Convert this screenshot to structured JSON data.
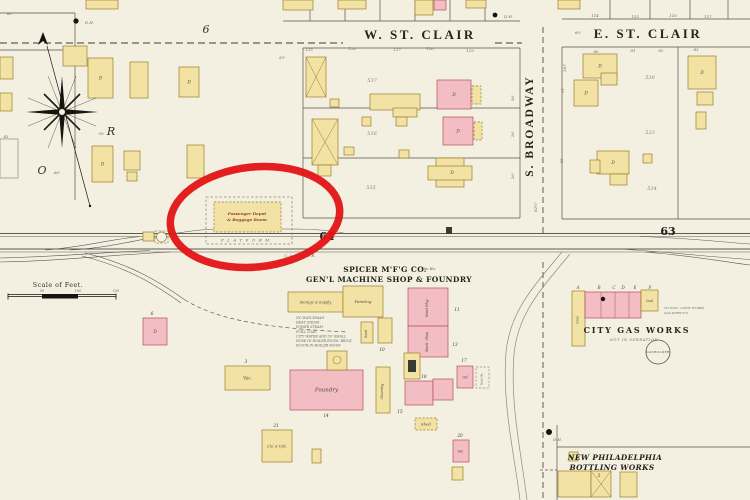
{
  "colors": {
    "paper": "#f4f0e1",
    "building_yellow": "#f2e2a4",
    "building_pink": "#f3bdc4",
    "annotation_red": "#e11414"
  },
  "labels": {
    "w_st_clair": "W. ST. CLAIR",
    "e_st_clair": "E. ST. CLAIR",
    "s_broadway": "S. BROADWAY",
    "block_64": "64",
    "block_63": "63",
    "spicer_line1": "SPICER M'F'G CO.",
    "spicer_line2": "GEN'L MACHINE SHOP & FOUNDRY",
    "gas_title": "CITY GAS WORKS",
    "gas_status": "NOT IN OPERATION",
    "gasholder": "GASHOLDER",
    "bottling_line1": "NEW PHILADELPHIA",
    "bottling_line2": "BOTTLING WORKS",
    "scale_title": "Scale of Feet.",
    "depot_line1": "Passenger Depot",
    "depot_line2": "& Baggage Room",
    "platform": "PLATFORM",
    "railroad_name": "C. L. & W. R. R."
  },
  "fire_notes": [
    "NO WATCHMAN",
    "HEAT STEAM",
    "POWER STEAM",
    "FUEL COAL",
    "CITY WATER AND 50' SMALL",
    "HOSE IN BOILER ROOM, BRICK",
    "FLOOR IN BOILER ROOM"
  ],
  "buildings": [
    {
      "x": 63,
      "y": 46,
      "w": 24,
      "h": 20,
      "f": "y"
    },
    {
      "x": 88,
      "y": 58,
      "w": 25,
      "h": 40,
      "f": "y",
      "l": "D",
      "n": "dwelling"
    },
    {
      "x": 130,
      "y": 62,
      "w": 18,
      "h": 36,
      "f": "y"
    },
    {
      "x": 179,
      "y": 67,
      "w": 20,
      "h": 30,
      "f": "y",
      "l": "D",
      "n": "dwelling"
    },
    {
      "x": 92,
      "y": 146,
      "w": 21,
      "h": 36,
      "f": "y",
      "l": "D",
      "n": "dwelling"
    },
    {
      "x": 124,
      "y": 151,
      "w": 16,
      "h": 19,
      "f": "y"
    },
    {
      "x": 187,
      "y": 145,
      "w": 17,
      "h": 33,
      "f": "y"
    },
    {
      "x": 127,
      "y": 172,
      "w": 10,
      "h": 9,
      "f": "y"
    },
    {
      "x": 0,
      "y": 57,
      "w": 13,
      "h": 22,
      "f": "y"
    },
    {
      "x": 0,
      "y": 93,
      "w": 12,
      "h": 18,
      "f": "y"
    },
    {
      "x": 0,
      "y": 139,
      "w": 18,
      "h": 39,
      "f": "n"
    },
    {
      "x": 86,
      "y": 0,
      "w": 32,
      "h": 9,
      "f": "y"
    },
    {
      "x": 283,
      "y": 0,
      "w": 30,
      "h": 10,
      "f": "y"
    },
    {
      "x": 338,
      "y": 0,
      "w": 28,
      "h": 9,
      "f": "y"
    },
    {
      "x": 415,
      "y": 0,
      "w": 18,
      "h": 15,
      "f": "y"
    },
    {
      "x": 434,
      "y": 0,
      "w": 12,
      "h": 10,
      "f": "p"
    },
    {
      "x": 466,
      "y": 0,
      "w": 20,
      "h": 8,
      "f": "y"
    },
    {
      "x": 558,
      "y": 0,
      "w": 22,
      "h": 9,
      "f": "y"
    },
    {
      "x": 306,
      "y": 57,
      "w": 20,
      "h": 40,
      "f": "y",
      "xm": true,
      "n": "stable"
    },
    {
      "x": 312,
      "y": 119,
      "w": 26,
      "h": 46,
      "f": "y",
      "xm": true,
      "n": "stable"
    },
    {
      "x": 318,
      "y": 165,
      "w": 13,
      "h": 11,
      "f": "y"
    },
    {
      "x": 330,
      "y": 99,
      "w": 9,
      "h": 8,
      "f": "y"
    },
    {
      "x": 370,
      "y": 94,
      "w": 50,
      "h": 16,
      "f": "y"
    },
    {
      "x": 393,
      "y": 108,
      "w": 24,
      "h": 9,
      "f": "y"
    },
    {
      "x": 437,
      "y": 80,
      "w": 34,
      "h": 29,
      "f": "p",
      "l": "D",
      "n": "dwelling"
    },
    {
      "x": 472,
      "y": 86,
      "w": 9,
      "h": 18,
      "f": "y",
      "dash": true,
      "n": "porch"
    },
    {
      "x": 362,
      "y": 117,
      "w": 9,
      "h": 9,
      "f": "y"
    },
    {
      "x": 396,
      "y": 117,
      "w": 11,
      "h": 9,
      "f": "y"
    },
    {
      "x": 443,
      "y": 117,
      "w": 30,
      "h": 28,
      "f": "p",
      "l": "D",
      "n": "dwelling"
    },
    {
      "x": 474,
      "y": 122,
      "w": 8,
      "h": 18,
      "f": "y",
      "dash": true,
      "n": "porch"
    },
    {
      "x": 344,
      "y": 147,
      "w": 10,
      "h": 8,
      "f": "y"
    },
    {
      "x": 399,
      "y": 150,
      "w": 10,
      "h": 8,
      "f": "y"
    },
    {
      "x": 436,
      "y": 158,
      "w": 28,
      "h": 29,
      "f": "y"
    },
    {
      "x": 428,
      "y": 166,
      "w": 44,
      "h": 14,
      "f": "y",
      "l": "D",
      "lx": 452,
      "ly": 174,
      "n": "dwelling"
    },
    {
      "x": 583,
      "y": 54,
      "w": 34,
      "h": 24,
      "f": "y",
      "l": "D",
      "n": "dwelling"
    },
    {
      "x": 574,
      "y": 80,
      "w": 24,
      "h": 26,
      "f": "y",
      "l": "D",
      "n": "dwelling"
    },
    {
      "x": 601,
      "y": 73,
      "w": 16,
      "h": 12,
      "f": "y"
    },
    {
      "x": 688,
      "y": 56,
      "w": 28,
      "h": 33,
      "f": "y",
      "l": "D",
      "n": "dwelling"
    },
    {
      "x": 697,
      "y": 92,
      "w": 16,
      "h": 13,
      "f": "y"
    },
    {
      "x": 696,
      "y": 112,
      "w": 10,
      "h": 17,
      "f": "y"
    },
    {
      "x": 597,
      "y": 151,
      "w": 32,
      "h": 23,
      "f": "y",
      "l": "D",
      "n": "dwelling"
    },
    {
      "x": 590,
      "y": 160,
      "w": 10,
      "h": 13,
      "f": "y"
    },
    {
      "x": 610,
      "y": 174,
      "w": 17,
      "h": 11,
      "f": "y"
    },
    {
      "x": 643,
      "y": 154,
      "w": 9,
      "h": 9,
      "f": "y"
    },
    {
      "x": 143,
      "y": 318,
      "w": 24,
      "h": 27,
      "f": "p",
      "l": "D",
      "n": "dwelling"
    },
    {
      "x": 225,
      "y": 366,
      "w": 45,
      "h": 24,
      "f": "y",
      "l": "Vac.",
      "n": "vacant-building"
    },
    {
      "x": 262,
      "y": 430,
      "w": 30,
      "h": 32,
      "f": "y",
      "l": "Clo. & Uph.",
      "ls": 3.3
    },
    {
      "x": 312,
      "y": 449,
      "w": 9,
      "h": 14,
      "f": "y"
    },
    {
      "x": 143,
      "y": 232,
      "w": 11,
      "h": 9,
      "f": "y",
      "n": "track-shed"
    },
    {
      "x": 155,
      "y": 231,
      "w": 13,
      "h": 12,
      "f": "n",
      "dash": true,
      "n": "tank-enclosure"
    },
    {
      "x": 214,
      "y": 202,
      "w": 67,
      "h": 30,
      "f": "y",
      "dash": true,
      "n": "passenger-depot"
    },
    {
      "x": 288,
      "y": 292,
      "w": 55,
      "h": 20,
      "f": "y",
      "l": "Storage & Supply",
      "ls": 3.5,
      "n": "storage-supply"
    },
    {
      "x": 343,
      "y": 286,
      "w": 40,
      "h": 31,
      "f": "y",
      "l": "Painting",
      "ls": 4,
      "n": "painting-shop"
    },
    {
      "x": 361,
      "y": 322,
      "w": 12,
      "h": 21,
      "f": "y",
      "l": "Sand",
      "lr": -90,
      "ls": 3.2
    },
    {
      "x": 378,
      "y": 318,
      "w": 14,
      "h": 25,
      "f": "y"
    },
    {
      "x": 408,
      "y": 288,
      "w": 40,
      "h": 38,
      "f": "p",
      "l": "Wood Wkg.",
      "lr": -90,
      "ls": 3.3,
      "lx": 428,
      "ly": 308,
      "n": "wood-working-shop"
    },
    {
      "x": 408,
      "y": 326,
      "w": 40,
      "h": 31,
      "f": "p",
      "l": "Mach. Shop",
      "lr": -90,
      "ls": 3.3,
      "lx": 428,
      "ly": 342,
      "n": "machine-shop"
    },
    {
      "x": 376,
      "y": 367,
      "w": 14,
      "h": 46,
      "f": "y",
      "l": "Cleaning",
      "lr": -90,
      "ls": 3.5,
      "n": "cleaning-shop"
    },
    {
      "x": 404,
      "y": 353,
      "w": 16,
      "h": 26,
      "f": "y",
      "n": "smith-shop"
    },
    {
      "x": 405,
      "y": 381,
      "w": 28,
      "h": 24,
      "f": "p"
    },
    {
      "x": 433,
      "y": 379,
      "w": 20,
      "h": 21,
      "f": "p"
    },
    {
      "x": 290,
      "y": 370,
      "w": 73,
      "h": 40,
      "f": "p",
      "l": "Foundry",
      "ls": 5.5,
      "n": "foundry"
    },
    {
      "x": 327,
      "y": 351,
      "w": 20,
      "h": 19,
      "f": "y",
      "n": "cupola-house"
    },
    {
      "x": 457,
      "y": 366,
      "w": 16,
      "h": 22,
      "f": "p",
      "l": "Oil",
      "ls": 3.6,
      "n": "oil-house"
    },
    {
      "x": 476,
      "y": 367,
      "w": 13,
      "h": 21,
      "f": "n",
      "dash": true,
      "l": "Tank Ho.",
      "lr": -90,
      "ls": 2.8,
      "n": "tank-house"
    },
    {
      "x": 415,
      "y": 418,
      "w": 22,
      "h": 12,
      "f": "y",
      "dash": true,
      "l": "Shed",
      "ls": 4,
      "n": "shed"
    },
    {
      "x": 453,
      "y": 440,
      "w": 16,
      "h": 22,
      "f": "p",
      "l": "Vac.",
      "ls": 3.2,
      "n": "vacant-building"
    },
    {
      "x": 452,
      "y": 467,
      "w": 11,
      "h": 13,
      "f": "y"
    },
    {
      "x": 572,
      "y": 291,
      "w": 13,
      "h": 55,
      "f": "y",
      "l": "Coal",
      "lr": -90,
      "ls": 3.2,
      "n": "gas-works-coal"
    },
    {
      "x": 585,
      "y": 292,
      "w": 56,
      "h": 26,
      "f": "p",
      "n": "gas-works-retort"
    },
    {
      "x": 641,
      "y": 290,
      "w": 17,
      "h": 21,
      "f": "y",
      "l": "Coal",
      "ls": 3.2,
      "n": "gas-works-coal"
    },
    {
      "x": 569,
      "y": 452,
      "w": 9,
      "h": 9,
      "f": "y"
    },
    {
      "x": 558,
      "y": 471,
      "w": 33,
      "h": 26,
      "f": "y",
      "n": "bottling-works"
    },
    {
      "x": 591,
      "y": 471,
      "w": 20,
      "h": 26,
      "f": "y",
      "xm": true,
      "n": "bottling-works"
    },
    {
      "x": 620,
      "y": 472,
      "w": 17,
      "h": 25,
      "f": "y"
    },
    {
      "x": 446,
      "y": 227,
      "w": 6,
      "h": 7,
      "f": "k",
      "n": "watch-box"
    }
  ],
  "small_labels": [
    {
      "t": "537",
      "x": 372,
      "y": 82,
      "c": "tp",
      "n": "parcel-number"
    },
    {
      "t": "536",
      "x": 372,
      "y": 135,
      "c": "tp",
      "n": "parcel-number"
    },
    {
      "t": "535",
      "x": 371,
      "y": 189,
      "c": "tp",
      "n": "parcel-number"
    },
    {
      "t": "538",
      "x": 650,
      "y": 79,
      "c": "tp",
      "n": "parcel-number"
    },
    {
      "t": "533",
      "x": 650,
      "y": 134,
      "c": "tp",
      "n": "parcel-number"
    },
    {
      "t": "534",
      "x": 652,
      "y": 190,
      "c": "tp",
      "n": "parcel-number"
    },
    {
      "t": "125",
      "x": 309,
      "y": 51,
      "n": "lot-number"
    },
    {
      "t": "126",
      "x": 352,
      "y": 50,
      "n": "lot-number"
    },
    {
      "t": "127",
      "x": 397,
      "y": 51,
      "n": "lot-number"
    },
    {
      "t": "128",
      "x": 430,
      "y": 50,
      "n": "lot-number"
    },
    {
      "t": "129",
      "x": 470,
      "y": 52,
      "n": "lot-number"
    },
    {
      "t": "114",
      "x": 595,
      "y": 17,
      "n": "lot-number"
    },
    {
      "t": "115",
      "x": 635,
      "y": 18,
      "n": "lot-number"
    },
    {
      "t": "116",
      "x": 673,
      "y": 17,
      "n": "lot-number"
    },
    {
      "t": "117",
      "x": 708,
      "y": 18,
      "n": "lot-number"
    },
    {
      "t": "80",
      "x": 596,
      "y": 53,
      "n": "lot-number"
    },
    {
      "t": "81",
      "x": 633,
      "y": 52,
      "n": "lot-number"
    },
    {
      "t": "82",
      "x": 661,
      "y": 52,
      "n": "lot-number"
    },
    {
      "t": "83",
      "x": 696,
      "y": 51,
      "n": "lot-number"
    },
    {
      "t": "55'",
      "x": 282,
      "y": 59,
      "n": "measurement"
    },
    {
      "t": "60'",
      "x": 578,
      "y": 34,
      "n": "measurement"
    },
    {
      "t": "66'",
      "x": 57,
      "y": 174,
      "n": "measurement"
    },
    {
      "t": "43",
      "x": 6,
      "y": 138,
      "n": "measurement"
    },
    {
      "t": "60'",
      "x": 10,
      "y": 15,
      "n": "measurement"
    },
    {
      "t": "59",
      "x": 101,
      "y": 135,
      "n": "measurement"
    },
    {
      "t": "367",
      "x": 566,
      "y": 68,
      "r": -90,
      "n": "measurement"
    },
    {
      "t": "51'",
      "x": 564,
      "y": 90,
      "r": -90,
      "n": "measurement"
    },
    {
      "t": "55",
      "x": 563,
      "y": 161,
      "r": -90,
      "n": "measurement"
    },
    {
      "t": "82½'",
      "x": 537,
      "y": 207,
      "r": -90,
      "n": "measurement"
    },
    {
      "t": "26'",
      "x": 514,
      "y": 98,
      "r": -90,
      "n": "measurement"
    },
    {
      "t": "26'",
      "x": 514,
      "y": 134,
      "r": -90,
      "n": "measurement"
    },
    {
      "t": "26'",
      "x": 514,
      "y": 176,
      "r": -90,
      "n": "measurement"
    },
    {
      "t": "11",
      "x": 457,
      "y": 311,
      "c": "tnum",
      "n": "building-number"
    },
    {
      "t": "13",
      "x": 455,
      "y": 346,
      "c": "tnum",
      "n": "building-number"
    },
    {
      "t": "17",
      "x": 464,
      "y": 362,
      "c": "tnum",
      "n": "building-number"
    },
    {
      "t": "18",
      "x": 424,
      "y": 378,
      "c": "tnum",
      "n": "building-number"
    },
    {
      "t": "14",
      "x": 326,
      "y": 417,
      "c": "tnum",
      "n": "building-number"
    },
    {
      "t": "15",
      "x": 400,
      "y": 413,
      "c": "tnum",
      "n": "building-number"
    },
    {
      "t": "10",
      "x": 382,
      "y": 351,
      "c": "tnum",
      "n": "building-number"
    },
    {
      "t": "6",
      "x": 152,
      "y": 315,
      "c": "tnum",
      "n": "building-number"
    },
    {
      "t": "3",
      "x": 246,
      "y": 363,
      "c": "tnum",
      "n": "building-number"
    },
    {
      "t": "21",
      "x": 276,
      "y": 427,
      "c": "tnum",
      "n": "building-number"
    },
    {
      "t": "20",
      "x": 460,
      "y": 437,
      "c": "tnum",
      "n": "building-number"
    },
    {
      "t": "2",
      "x": 599,
      "y": 477,
      "c": "tnum",
      "n": "building-number"
    },
    {
      "t": "1",
      "x": 573,
      "y": 458,
      "c": "tnum",
      "n": "building-number"
    },
    {
      "t": "A",
      "x": 578,
      "y": 289,
      "c": "tt",
      "n": "gas-building-letter"
    },
    {
      "t": "B",
      "x": 599,
      "y": 289,
      "c": "tt",
      "n": "gas-building-letter"
    },
    {
      "t": "C",
      "x": 614,
      "y": 289,
      "c": "tt",
      "n": "gas-building-letter"
    },
    {
      "t": "D",
      "x": 623,
      "y": 289,
      "c": "tt",
      "n": "gas-building-letter"
    },
    {
      "t": "E",
      "x": 635,
      "y": 289,
      "c": "tt",
      "n": "gas-building-letter"
    },
    {
      "t": "F",
      "x": 650,
      "y": 289,
      "c": "tt",
      "n": "gas-building-letter"
    },
    {
      "t": "50",
      "x": 42,
      "y": 292,
      "s": 3.4,
      "n": "scale-tick"
    },
    {
      "t": "100",
      "x": 78,
      "y": 292,
      "s": 3.4,
      "n": "scale-tick"
    },
    {
      "t": "150",
      "x": 116,
      "y": 292,
      "s": 3.4,
      "n": "scale-tick"
    },
    {
      "t": "D.H.",
      "x": 85,
      "y": 24,
      "a": "start",
      "n": "hydrant-label"
    },
    {
      "t": "D.H.",
      "x": 504,
      "y": 18,
      "a": "start",
      "n": "hydrant-label"
    },
    {
      "t": "D.H.",
      "x": 553,
      "y": 441,
      "a": "start",
      "n": "hydrant-label"
    },
    {
      "t": "O",
      "x": 42,
      "y": 174,
      "c": "tsc",
      "n": "script-letter"
    },
    {
      "t": "R",
      "x": 111,
      "y": 135,
      "c": "tsc",
      "n": "script-letter"
    },
    {
      "t": "6",
      "x": 206,
      "y": 33,
      "c": "tsc",
      "n": "script-letter"
    },
    {
      "t": "TO ELEC. LIGHT WORKS",
      "x": 664,
      "y": 309,
      "a": "start",
      "s": 3.1,
      "n": "margin-note"
    },
    {
      "t": "GAS DIRECT'N.",
      "x": 664,
      "y": 314,
      "a": "start",
      "s": 3.1,
      "n": "margin-note"
    },
    {
      "t": "Dw. Ho.",
      "x": 429,
      "y": 270,
      "c": "tt",
      "s": 3.4,
      "n": "margin-note"
    }
  ]
}
